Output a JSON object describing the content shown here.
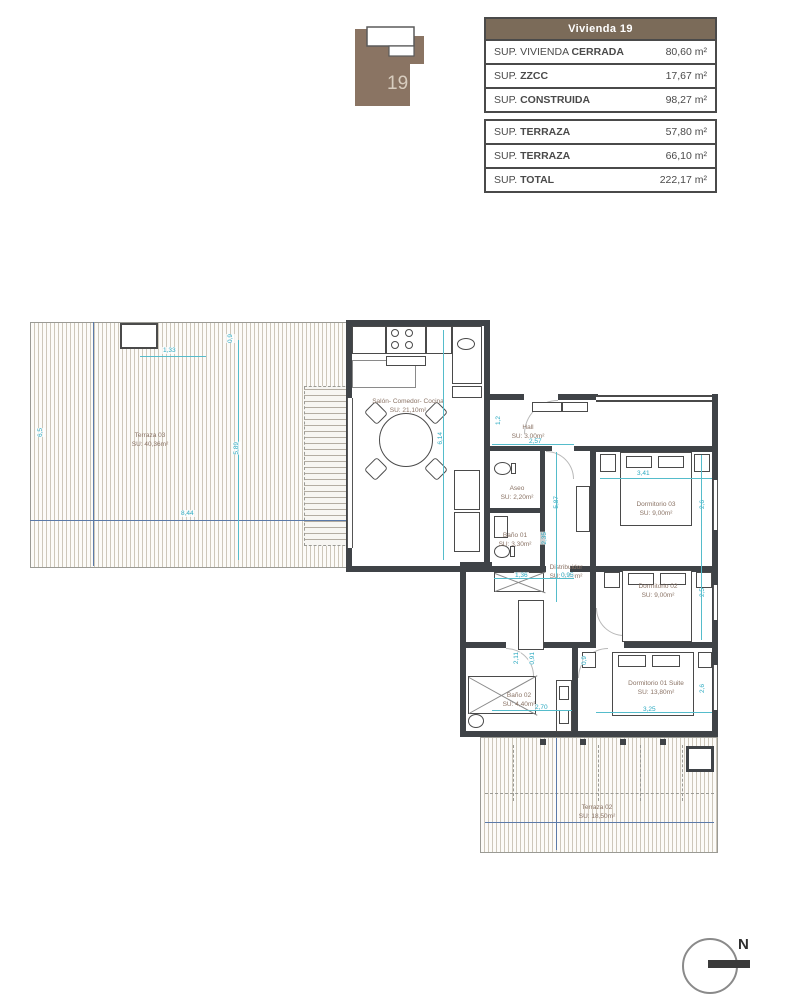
{
  "colors": {
    "accent_brown": "#7b6b59",
    "logo_brown": "#8a7463",
    "wall_dark": "#3f4347",
    "dimension_cyan": "#2aa9c0",
    "room_label_brown": "#8a7365",
    "construction_blue": "#5b7aa8"
  },
  "logo": {
    "unit_number": "19"
  },
  "summary_table": {
    "header": "Vivienda 19",
    "rows": [
      {
        "label_prefix": "SUP. VIVIENDA",
        "label_bold": "CERRADA",
        "value": "80,60 m²"
      },
      {
        "label_prefix": "SUP.",
        "label_bold": "ZZCC",
        "value": "17,67 m²"
      },
      {
        "label_prefix": "SUP.",
        "label_bold": "CONSTRUIDA",
        "value": "98,27 m²"
      }
    ]
  },
  "terrace_table": {
    "rows": [
      {
        "label_prefix": "SUP.",
        "label_bold": "TERRAZA",
        "value": "57,80 m²"
      },
      {
        "label_prefix": "SUP.",
        "label_bold": "TERRAZA",
        "value": "66,10 m²"
      },
      {
        "label_prefix": "SUP.",
        "label_bold": "TOTAL",
        "value": "222,17 m²"
      }
    ]
  },
  "plan": {
    "rooms": [
      {
        "name": "Terraza 03",
        "area": "SU: 40,36m²"
      },
      {
        "name": "Salón- Comedor- Cocina",
        "area": "SU: 21,10m²"
      },
      {
        "name": "Hall",
        "area": "SU: 3,00m²"
      },
      {
        "name": "Aseo",
        "area": "SU: 2,20m²"
      },
      {
        "name": "Baño 01",
        "area": "SU: 3,30m²"
      },
      {
        "name": "Distribuidor",
        "area": "SU: 3,90m²"
      },
      {
        "name": "Dormitorio 03",
        "area": "SU: 9,00m²"
      },
      {
        "name": "Dormitorio 02",
        "area": "SU: 9,00m²"
      },
      {
        "name": "Dormitorio 01 Suite",
        "area": "SU: 13,80m²"
      },
      {
        "name": "Baño 02",
        "area": "SU: 4,40m²"
      },
      {
        "name": "Terraza 02",
        "area": "SU: 18,50m²"
      }
    ],
    "dimensions": [
      {
        "value": "1,33"
      },
      {
        "value": "0,9"
      },
      {
        "value": "6,5"
      },
      {
        "value": "8,44"
      },
      {
        "value": "5,89"
      },
      {
        "value": "6,14"
      },
      {
        "value": "1,2"
      },
      {
        "value": "2,57"
      },
      {
        "value": "5,87"
      },
      {
        "value": "3,41"
      },
      {
        "value": "2,6"
      },
      {
        "value": "2,5"
      },
      {
        "value": "2,35"
      },
      {
        "value": "1,36"
      },
      {
        "value": "0,95"
      },
      {
        "value": "2,11"
      },
      {
        "value": "0,91"
      },
      {
        "value": "0,9"
      },
      {
        "value": "2,70"
      },
      {
        "value": "3,25"
      },
      {
        "value": "2,6"
      }
    ],
    "compass": {
      "label": "N"
    }
  }
}
